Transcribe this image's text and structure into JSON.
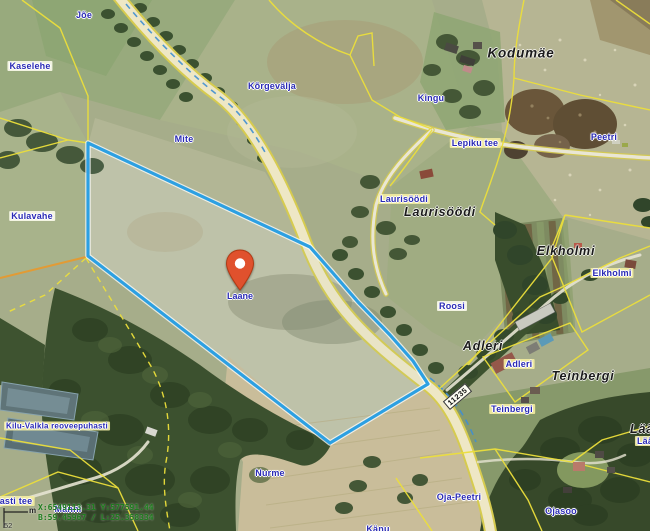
{
  "map": {
    "title": "aerial cadastral map",
    "pin": {
      "label": "Laane",
      "color": "#e0512d"
    },
    "road_badge": "11235",
    "labels": {
      "joe": "Jõe",
      "kaselehe": "Kaselehe",
      "mite": "Mite",
      "korgevalja": "Kõrgevälja",
      "kingu": "Kingu",
      "kodumae": "Kodumäe",
      "lepiku_tee": "Lepiku tee",
      "peetri": "Peetri",
      "laurisoodi_parcel": "Laurisöödi",
      "laurisoodi_village": "Laurisöödi",
      "kulavahe": "Kulavahe",
      "elkholmi_village": "Elkholmi",
      "elkholmi_parcel": "Elkholmi",
      "roosi": "Roosi",
      "adleri_village": "Adleri",
      "adleri_parcel": "Adleri",
      "teinbergi_village": "Teinbergi",
      "teinbergi_parcel": "Teinbergi",
      "kilu_valkla": "Kilu-Valkla reoveepuhasti",
      "nurme": "Nurme",
      "oja_peetri": "Oja-Peetri",
      "ojasoo": "Ojasoo",
      "kanu": "Känu",
      "asti_tee": "asti tee",
      "laa_village": "Lää",
      "laa_parcel": "Lää",
      "manni": "Männi"
    },
    "overlay": {
      "line1": "X:6549113.31 Y:577591.44",
      "line2": "B:59.45967 / L:25.358334",
      "scale_unit": "m",
      "scale_number": "52"
    },
    "colors": {
      "parcel_highlight": "#2da0e2",
      "cadastral_line": "#ecdf3b",
      "parcel_label_blue": "#2b2bb5",
      "coords_green": "#1e7d1e",
      "pin": "#e0512d"
    }
  }
}
